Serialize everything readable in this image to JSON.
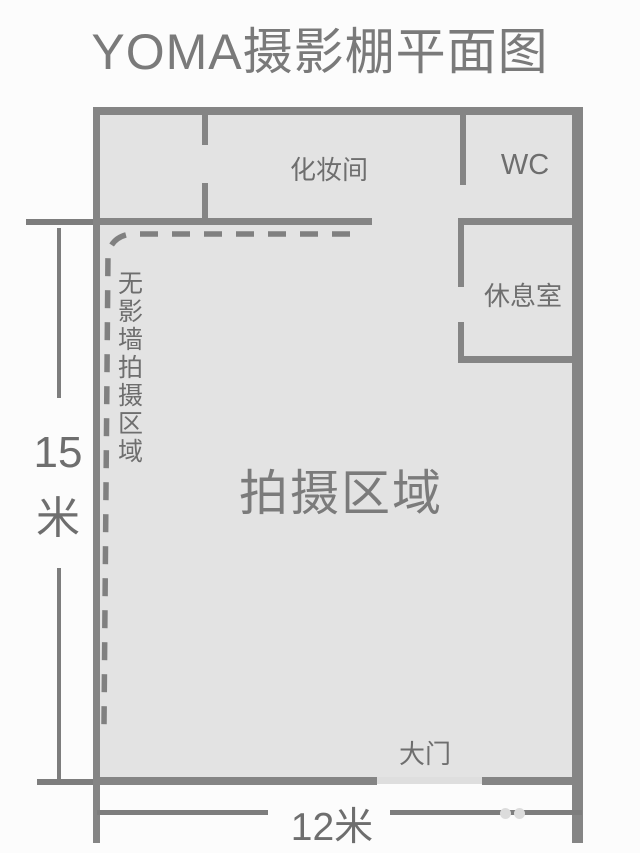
{
  "title": "YOMA摄影棚平面图",
  "colors": {
    "wall": "#858585",
    "floor": "#e3e3e3",
    "label": "#6e6e6e",
    "dimension_line": "#7d7d7d",
    "background": "#fcfcfc"
  },
  "rooms": {
    "dressing": {
      "label": "化妆间"
    },
    "wc": {
      "label": "WC"
    },
    "rest": {
      "label": "休息室"
    },
    "shooting": {
      "label": "拍摄区域"
    },
    "shadowless": {
      "label": "无影墙拍摄区域"
    },
    "gate": {
      "label": "大门"
    }
  },
  "dimensions": {
    "left": {
      "value": "15",
      "unit": "米"
    },
    "bottom": {
      "value": "12米"
    }
  }
}
